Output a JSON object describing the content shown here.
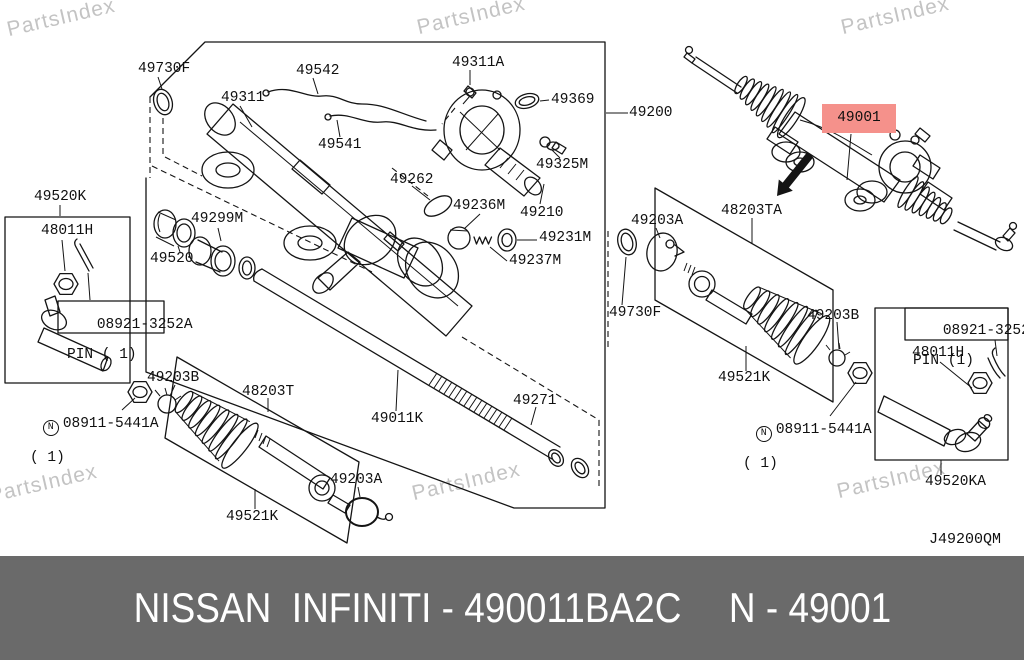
{
  "watermark": {
    "text": "PartsIndex"
  },
  "diagram": {
    "ref_code": "J49200QM",
    "highlighted_part": "49001",
    "highlight_color": "#f5918b",
    "labels": [
      {
        "text": "49730F"
      },
      {
        "text": "49542"
      },
      {
        "text": "49311"
      },
      {
        "text": "49541"
      },
      {
        "text": "49311A"
      },
      {
        "text": "49369"
      },
      {
        "text": "49200"
      },
      {
        "text": "49325M"
      },
      {
        "text": "49262"
      },
      {
        "text": "49236M"
      },
      {
        "text": "49210"
      },
      {
        "text": "49231M"
      },
      {
        "text": "49237M"
      },
      {
        "text": "49299M"
      },
      {
        "text": "49520"
      },
      {
        "text": "49520K"
      },
      {
        "text": "48011H"
      },
      {
        "text": "08921-3252A",
        "sub": "PIN ( 1)"
      },
      {
        "prefix": "N",
        "text": "08911-5441A",
        "sub": "( 1)"
      },
      {
        "text": "49203B"
      },
      {
        "text": "48203T"
      },
      {
        "text": "49011K"
      },
      {
        "text": "49271"
      },
      {
        "text": "49521K"
      },
      {
        "text": "49203A"
      },
      {
        "text": "49001"
      },
      {
        "text": "48203TA"
      },
      {
        "text": "49203A"
      },
      {
        "text": "49730F"
      },
      {
        "text": "49203B"
      },
      {
        "text": "49521K"
      },
      {
        "prefix": "N",
        "text": "08911-5441A",
        "sub": "( 1)"
      },
      {
        "text": "08921-3252A",
        "sub": "PIN (1)"
      },
      {
        "text": "48011H"
      },
      {
        "text": "49520KA"
      }
    ]
  },
  "footer": {
    "left": "NISSAN  INFINITI - 490011BA2C",
    "right": "N - 49001",
    "bg": "#6a6a6a",
    "color": "#ffffff"
  }
}
